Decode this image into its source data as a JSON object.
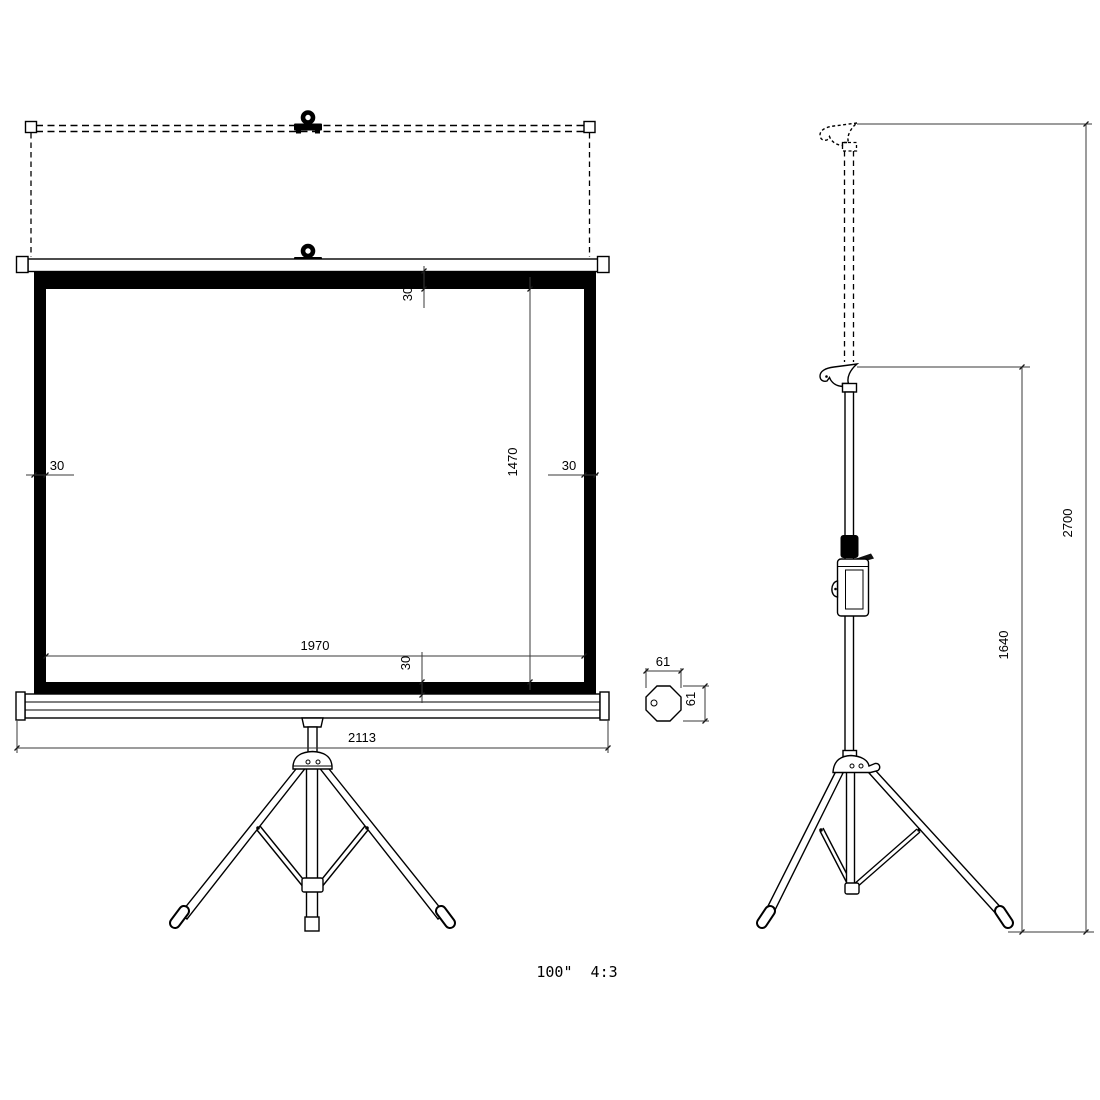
{
  "drawing": {
    "caption": "100\"  4:3",
    "front_view": {
      "dim_border_top": "30",
      "dim_border_left": "30",
      "dim_border_right": "30",
      "dim_border_bottom": "30",
      "dim_viewing_width": "1970",
      "dim_viewing_height": "1470",
      "dim_case_width": "2113"
    },
    "cross_section": {
      "dim_width": "61",
      "dim_height": "61"
    },
    "side_view": {
      "dim_total_height": "2700",
      "dim_stand_height": "1640"
    },
    "colors": {
      "line": "#000000",
      "dimension_line": "#3a3a3a",
      "background": "#ffffff"
    }
  }
}
